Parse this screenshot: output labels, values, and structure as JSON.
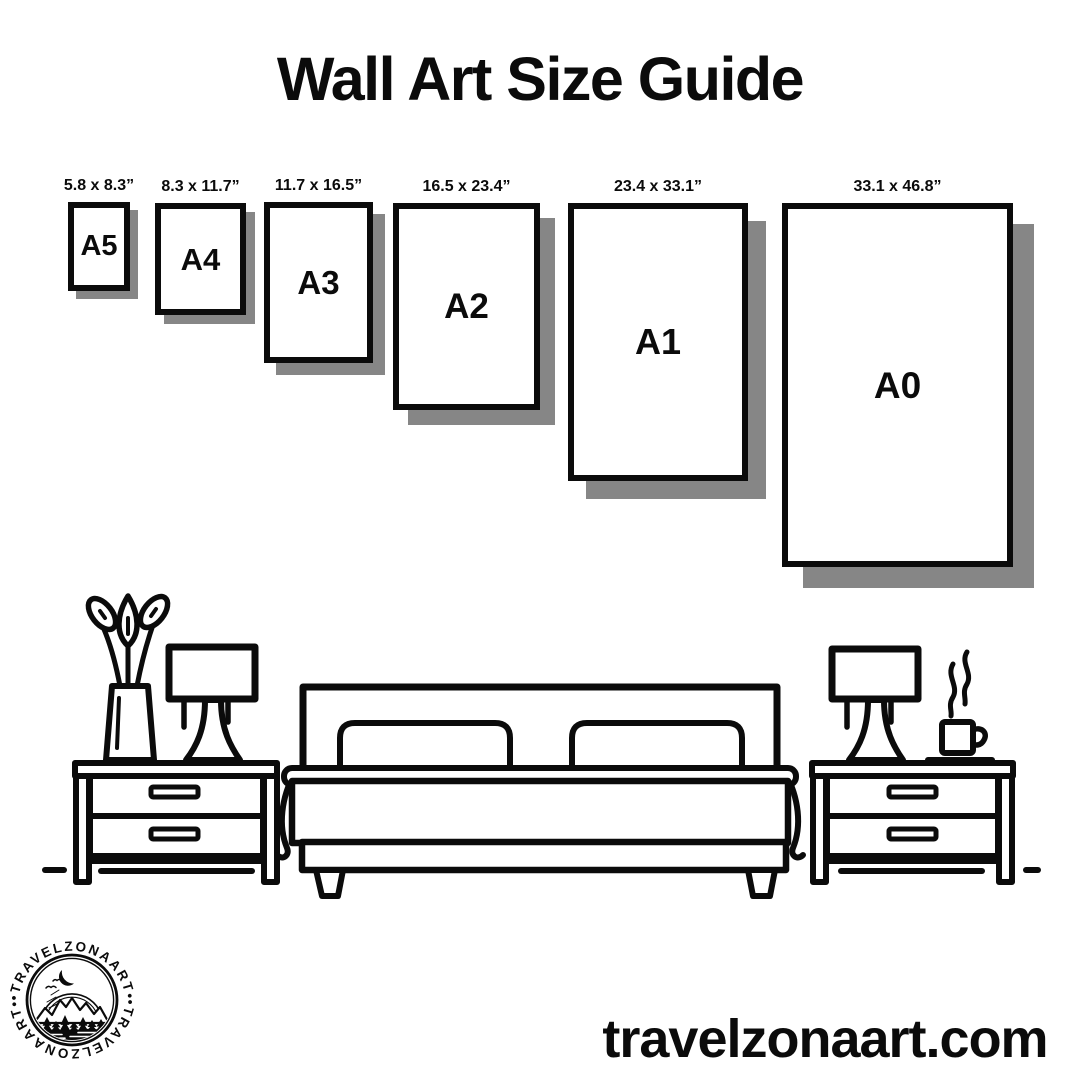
{
  "page": {
    "title": "Wall Art Size Guide"
  },
  "colors": {
    "ink": "#0b0b0b",
    "shadow": "#868686",
    "background": "#ffffff"
  },
  "size_guide": {
    "items": [
      {
        "code": "A5",
        "dims": "5.8 x 8.3”"
      },
      {
        "code": "A4",
        "dims": "8.3 x 11.7”"
      },
      {
        "code": "A3",
        "dims": "11.7 x 16.5”"
      },
      {
        "code": "A2",
        "dims": "16.5 x 23.4”"
      },
      {
        "code": "A1",
        "dims": "23.4 x 33.1”"
      },
      {
        "code": "A0",
        "dims": "33.1 x 46.8”"
      }
    ]
  },
  "illustration": {
    "icons": [
      "flower-vase-icon",
      "table-lamp-icon",
      "nightstand-icon",
      "double-bed-icon",
      "pillow-icon",
      "coffee-cup-icon",
      "steam-icon",
      "floor-line"
    ]
  },
  "logo": {
    "brand_top": "•TRAVELZONAART•",
    "brand_bottom": "•TRAVELZONAART•"
  },
  "footer": {
    "website": "travelzonaart.com"
  }
}
